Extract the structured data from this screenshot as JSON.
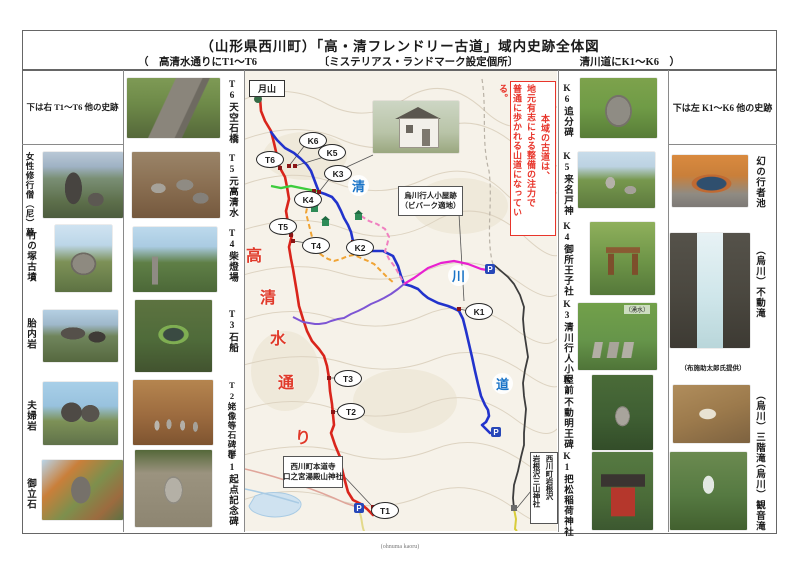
{
  "title": {
    "line1": "（山形県西川町）「高・清フレンドリー古道」域内史跡全体図",
    "line2_left": "（　高清水通りにT1～T6",
    "line2_mid": "〔ミステリアス・ランドマーク設定個所〕",
    "line2_right": "清川道にK1～K6　）"
  },
  "left_outer": {
    "header": "下は右 T1～T6 他の史跡",
    "items": [
      {
        "label": "女性修行僧（尼）墓"
      },
      {
        "label": "竹の塚古墳"
      },
      {
        "label": "胎内岩"
      },
      {
        "label": "夫婦岩"
      },
      {
        "label": "御立石"
      }
    ]
  },
  "t_column": {
    "items": [
      {
        "label": "T6天空石橋"
      },
      {
        "label": "T5元高清水"
      },
      {
        "label": "T4柴燈場"
      },
      {
        "label": "T3石船"
      },
      {
        "label": "T2姥像等石碑群"
      },
      {
        "label": "T1起点記念碑"
      }
    ]
  },
  "k_column": {
    "items": [
      {
        "label": "K6追分碑"
      },
      {
        "label": "K5来名戸神"
      },
      {
        "label": "K4御所王子社"
      },
      {
        "label": "K3清川行人小屋前",
        "photo_note": "（湧水）"
      },
      {
        "label": "K2不動明王碑"
      },
      {
        "label": "K1把松稲荷神社"
      }
    ]
  },
  "right_outer": {
    "header": "下は左 K1～K6 他の史跡",
    "items": [
      {
        "label": "幻の行者池"
      },
      {
        "label": "（烏川）不動滝"
      },
      {
        "label": "（烏川）三階滝"
      },
      {
        "label": "（烏川）観音滝"
      }
    ],
    "photo_credit": "（布施助太郎氏提供）"
  },
  "map": {
    "summit": "月山",
    "hut_caption": "清川行人小屋",
    "bivouac": {
      "line1": "烏川行人小屋跡",
      "line2": "（ビバーク適地）"
    },
    "notice": {
      "col1": "本域の古道は、",
      "col2": "地元有志による整備の注力で",
      "col3": "普通に歩かれる山道になっている。"
    },
    "route_left_chars": [
      "高",
      "清",
      "水",
      "通",
      "り"
    ],
    "route_right_chars": [
      "清",
      "川",
      "道"
    ],
    "choseki_note": "T1からT5までに丁石点在",
    "temple_callout": {
      "line1": "西川町本道寺",
      "line2": "口之宮湯殿山神社"
    },
    "iwanesawa_callout": {
      "line1": "西川町岩根沢",
      "line2": "岩根沢三山神社"
    },
    "markers": {
      "t6": "T6",
      "k6": "K6",
      "k5": "K5",
      "k3": "K3",
      "k4": "K4",
      "t5": "T5",
      "t4": "T4",
      "k2": "K2",
      "k1": "K1",
      "t3": "T3",
      "t2": "T2",
      "t1": "T1"
    },
    "parking": "P",
    "colors": {
      "takashimizu_route": "#d9251c",
      "kiyokawa_route": "#2233cc",
      "notice_red": "#e8352b",
      "magenta_route": "#e820d0",
      "purple_route": "#7d55d4",
      "green_segment": "#3dcc3d",
      "orange_route": "#f0a435"
    }
  },
  "footer": {
    "credit": "(ohnuma kaoru)"
  }
}
